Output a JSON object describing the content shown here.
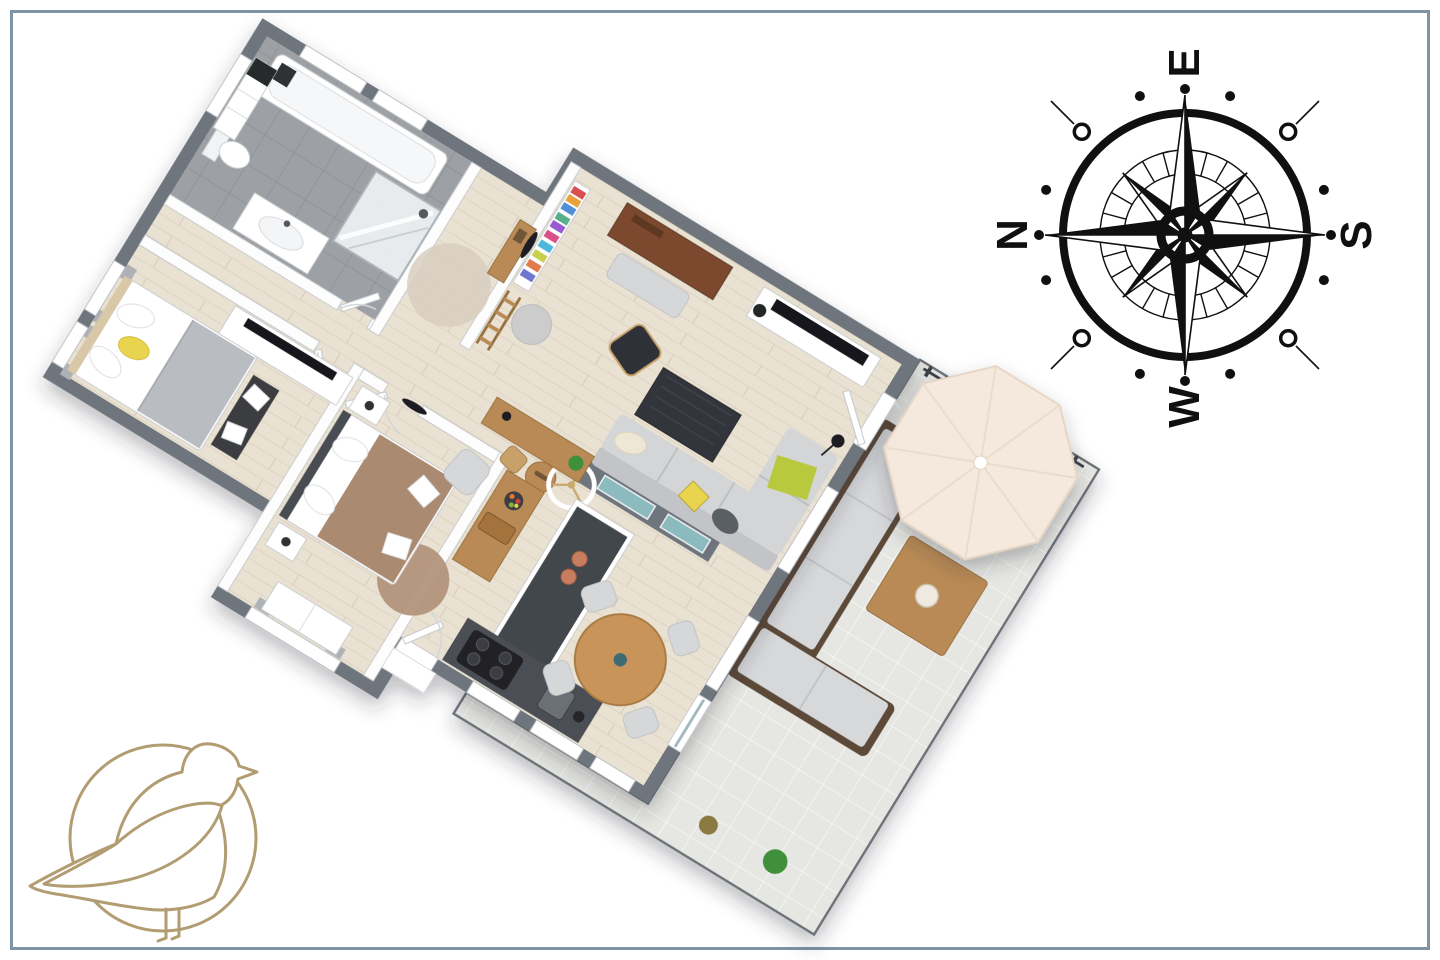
{
  "compass": {
    "labels": {
      "top": "E",
      "right": "S",
      "bottom": "W",
      "left": "N"
    }
  },
  "logo": {
    "name": "seagull-logo"
  },
  "colors": {
    "frame": "#7e93a3",
    "wall": "#6e757d",
    "wood": "#b98a54",
    "dark": "#3c4045",
    "glass": "#8fc2c7",
    "compass": "#101010",
    "gold": "#b29d72",
    "floor_wood": "#e9e1d2",
    "floor_bath": "#9da1a5",
    "floor_terrace": "#e6e7e2",
    "umbrella": "#f4e9dc",
    "sofa": "#d4d5d7",
    "accent_lime": "#b9c93e",
    "accent_yellow": "#e8d44f",
    "bed2_duvet": "#ab8a72",
    "rug_beige": "#d8cec0",
    "rug_brown": "#b08f77"
  },
  "floorplan": {
    "rooms": [
      "bathroom",
      "hallway",
      "bedroom-1",
      "bedroom-2",
      "living-room",
      "kitchen",
      "dining-area",
      "terrace"
    ],
    "furniture": {
      "bathroom": [
        "bathtub",
        "walk-in-shower",
        "toilet",
        "vanity-sink",
        "storage-column"
      ],
      "hallway": [
        "round-rug",
        "console-table",
        "wall-mirror",
        "ladder-shelf"
      ],
      "bedroom-1": [
        "double-bed",
        "dresser-with-tv",
        "bench",
        "curtained-windows"
      ],
      "bedroom-2": [
        "double-bed",
        "nightstands",
        "round-rug",
        "armchair",
        "wardrobe",
        "wall-tv"
      ],
      "living-room": [
        "bookshelf",
        "pouf",
        "desk",
        "bench",
        "tv-sideboard",
        "armchair",
        "coffee-table",
        "corner-sofa",
        "floor-lamp",
        "ceiling-fan",
        "round-stool",
        "glass-half-wall"
      ],
      "kitchen": [
        "wood-counter",
        "dark-counter",
        "island",
        "cooktop",
        "sink",
        "kettle",
        "fruit-bowl",
        "cutting-board"
      ],
      "dining-area": [
        "round-dining-table",
        "four-chairs"
      ],
      "terrace": [
        "outdoor-corner-sofa",
        "outdoor-coffee-table",
        "parasol",
        "railing",
        "plants",
        "tiled-floor"
      ]
    }
  }
}
